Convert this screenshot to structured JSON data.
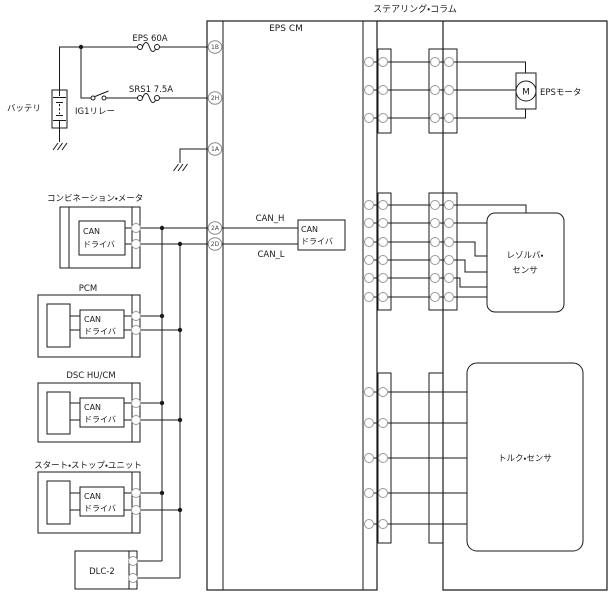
{
  "diagram": {
    "steering_column_label": "ステアリング・コラム",
    "eps_cm_label": "EPS CM",
    "battery_label": "バッテリ",
    "fuse_eps_label": "EPS 60A",
    "fuse_srs_label": "SRS1 7.5A",
    "relay_label": "IG1リレー",
    "pins": {
      "p1b": "1B",
      "p2h": "2H",
      "p1a": "1A",
      "p2a": "2A",
      "p2d": "2D"
    },
    "can_h_label": "CAN_H",
    "can_l_label": "CAN_L",
    "can_driver_line1": "CAN",
    "can_driver_line2": "ドライバ",
    "combination_meter_label": "コンビネーション・メータ",
    "pcm_label": "PCM",
    "dsc_label": "DSC HU/CM",
    "start_stop_label": "スタート・ストップ・ユニット",
    "dlc2_label": "DLC-2",
    "motor_m": "M",
    "motor_label": "EPSモータ",
    "resolver_line1": "レゾルバ・",
    "resolver_line2": "センサ",
    "torque_label": "トルク・センサ",
    "colors": {
      "line": "#1a1a1a",
      "connector_circle": "#999999",
      "background": "#ffffff"
    }
  }
}
